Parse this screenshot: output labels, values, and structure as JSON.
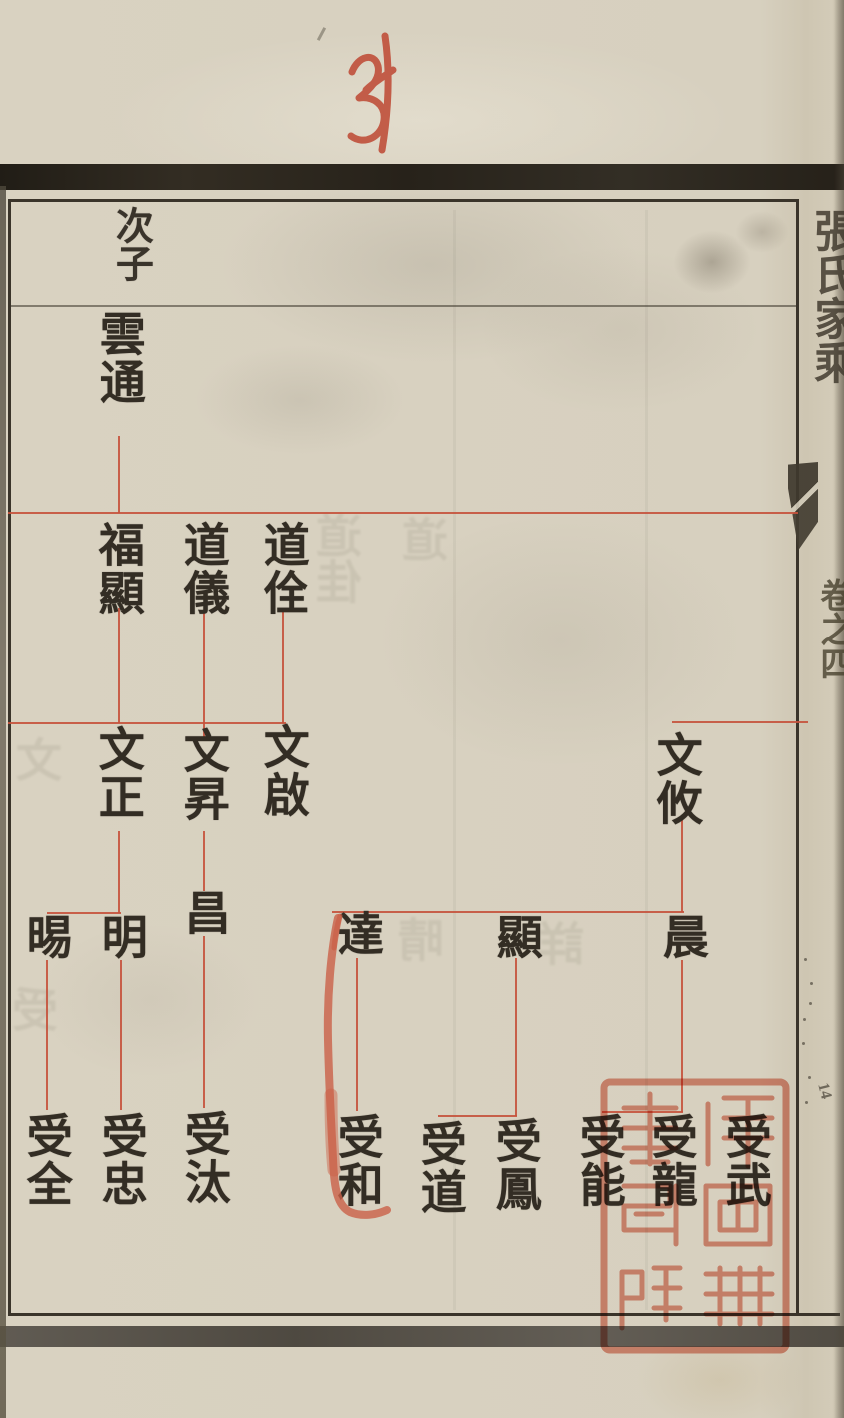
{
  "page": {
    "handwritten_number": "34",
    "edge_page_mark": "14"
  },
  "margin": {
    "title": "張氏家乘",
    "volume": "卷之四"
  },
  "header": {
    "label": "次子"
  },
  "tree": {
    "nodes": [
      {
        "name": "雲通",
        "generation": "1"
      },
      {
        "name": "福顯",
        "generation": "2"
      },
      {
        "name": "道儀",
        "generation": "2"
      },
      {
        "name": "道佺",
        "generation": "2"
      },
      {
        "name": "文正",
        "generation": "3"
      },
      {
        "name": "文昇",
        "generation": "3"
      },
      {
        "name": "文啟",
        "generation": "3"
      },
      {
        "name": "文攸",
        "generation": "3"
      },
      {
        "name": "晹",
        "generation": "4"
      },
      {
        "name": "明",
        "generation": "4"
      },
      {
        "name": "昌",
        "generation": "4"
      },
      {
        "name": "達",
        "generation": "4"
      },
      {
        "name": "顯",
        "generation": "4"
      },
      {
        "name": "晨",
        "generation": "4"
      },
      {
        "name": "受全",
        "generation": "5"
      },
      {
        "name": "受忠",
        "generation": "5"
      },
      {
        "name": "受汰",
        "generation": "5"
      },
      {
        "name": "受和",
        "generation": "5"
      },
      {
        "name": "受道",
        "generation": "5"
      },
      {
        "name": "受鳳",
        "generation": "5"
      },
      {
        "name": "受能",
        "generation": "5"
      },
      {
        "name": "受龍",
        "generation": "5"
      },
      {
        "name": "受武",
        "generation": "5"
      }
    ]
  },
  "seal": {
    "legible_character": "圖",
    "color": "#dc6a52"
  },
  "colors": {
    "paper": "#d6cfbe",
    "ink": "#332d24",
    "connector_red": "#c5523c",
    "handwriting_red": "#bf4c37"
  },
  "ghosts": [
    {
      "t": "道佳",
      "x": 338,
      "y": 512
    },
    {
      "t": "道",
      "x": 424,
      "y": 516
    },
    {
      "t": "文",
      "x": 22,
      "y": 736
    },
    {
      "t": "晴",
      "x": 416,
      "y": 916
    },
    {
      "t": "詳",
      "x": 558,
      "y": 920
    },
    {
      "t": "受",
      "x": 28,
      "y": 986
    }
  ]
}
